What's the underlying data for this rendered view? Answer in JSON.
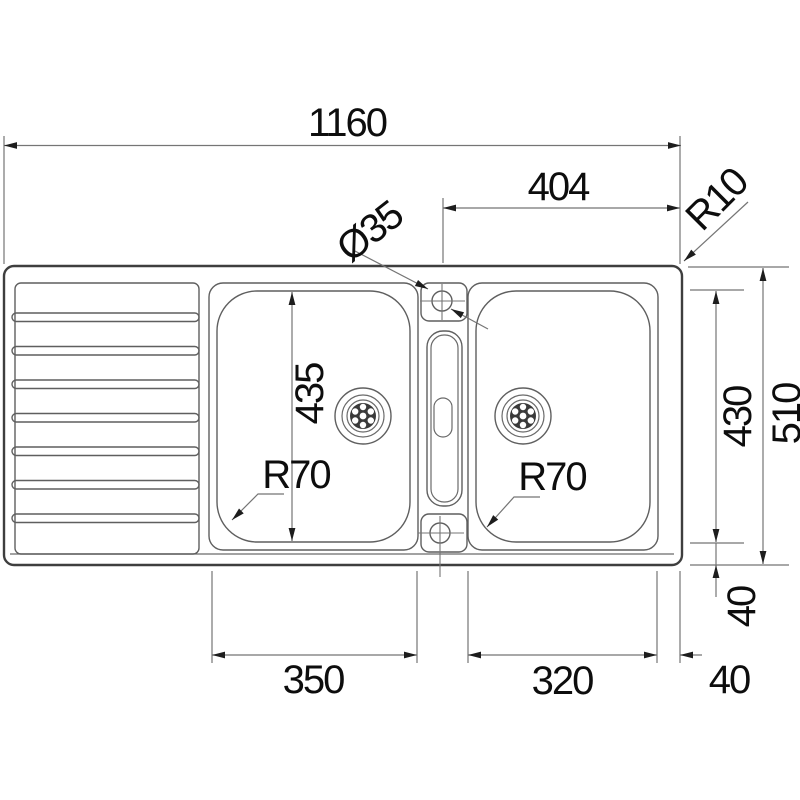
{
  "drawing": {
    "dims": {
      "overall_width": "1160",
      "tap_center_to_right_edge": "404",
      "deck_corner_radius": "R10",
      "tap_hole_diameter": "Ø35",
      "left_bowl_front_to_back": "435",
      "left_bowl_corner_radius": "R70",
      "right_bowl_corner_radius": "R70",
      "right_bowl_front_to_back": "430",
      "overall_depth": "510",
      "left_bowl_width": "350",
      "right_bowl_width": "320",
      "bowl_to_front_edge": "40",
      "bowl_to_right_edge": "40"
    }
  }
}
